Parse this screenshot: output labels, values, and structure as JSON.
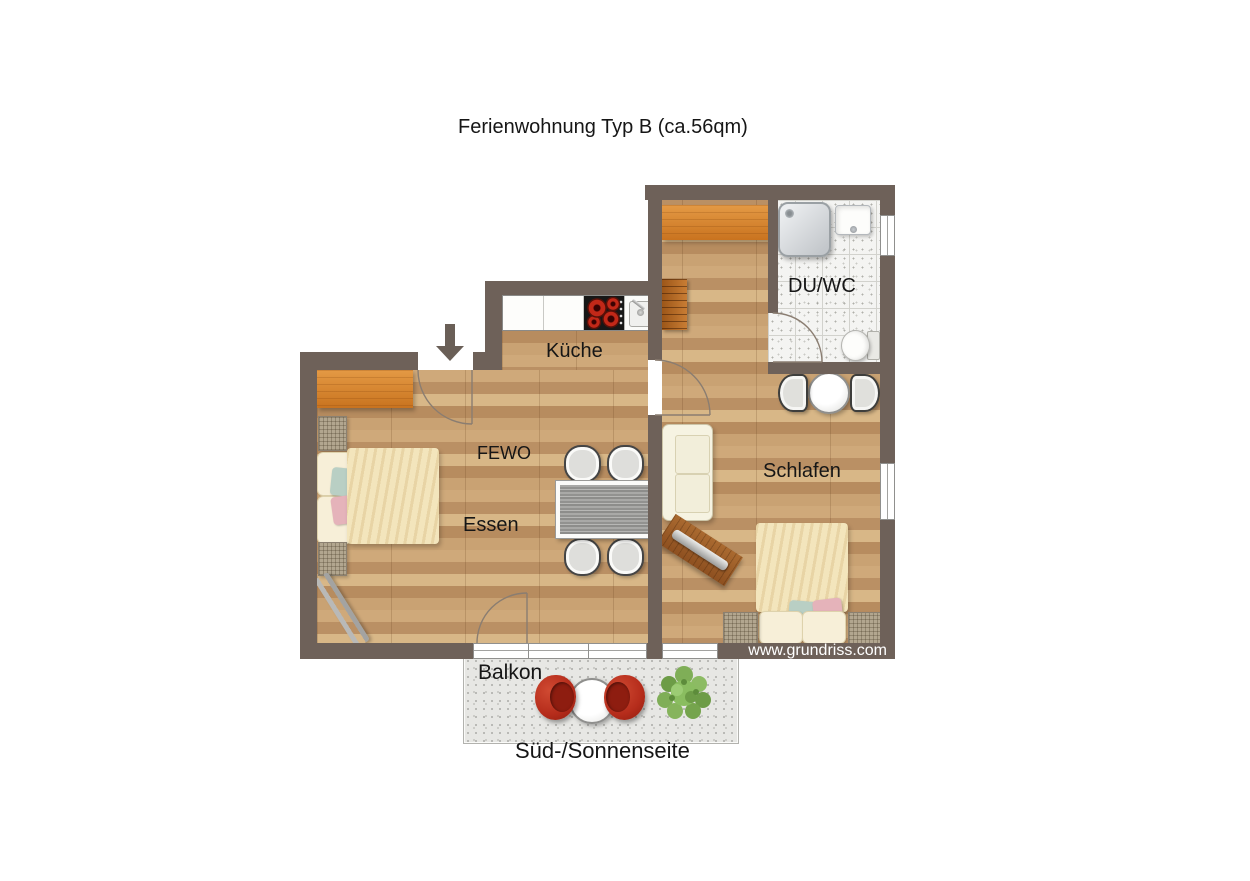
{
  "title": "Ferienwohnung Typ B (ca.56qm)",
  "rooms": {
    "kueche": "Küche",
    "fewo": "FEWO",
    "essen": "Essen",
    "schlafen": "Schlafen",
    "duwc": "DU/WC",
    "balkon": "Balkon"
  },
  "caption": "Süd-/Sonnenseite",
  "watermark": "www.grundriss.com",
  "colors": {
    "wall": "#6e6159",
    "wood_floor": "#c6a174",
    "furniture_orange": "#d07b2a",
    "balcony_chair_red": "#b52c1b",
    "bath_tile": "#f4f4f2",
    "balcony_floor": "#e7e7e4"
  },
  "icons": {
    "entrance_arrow": "arrow-down-icon"
  }
}
